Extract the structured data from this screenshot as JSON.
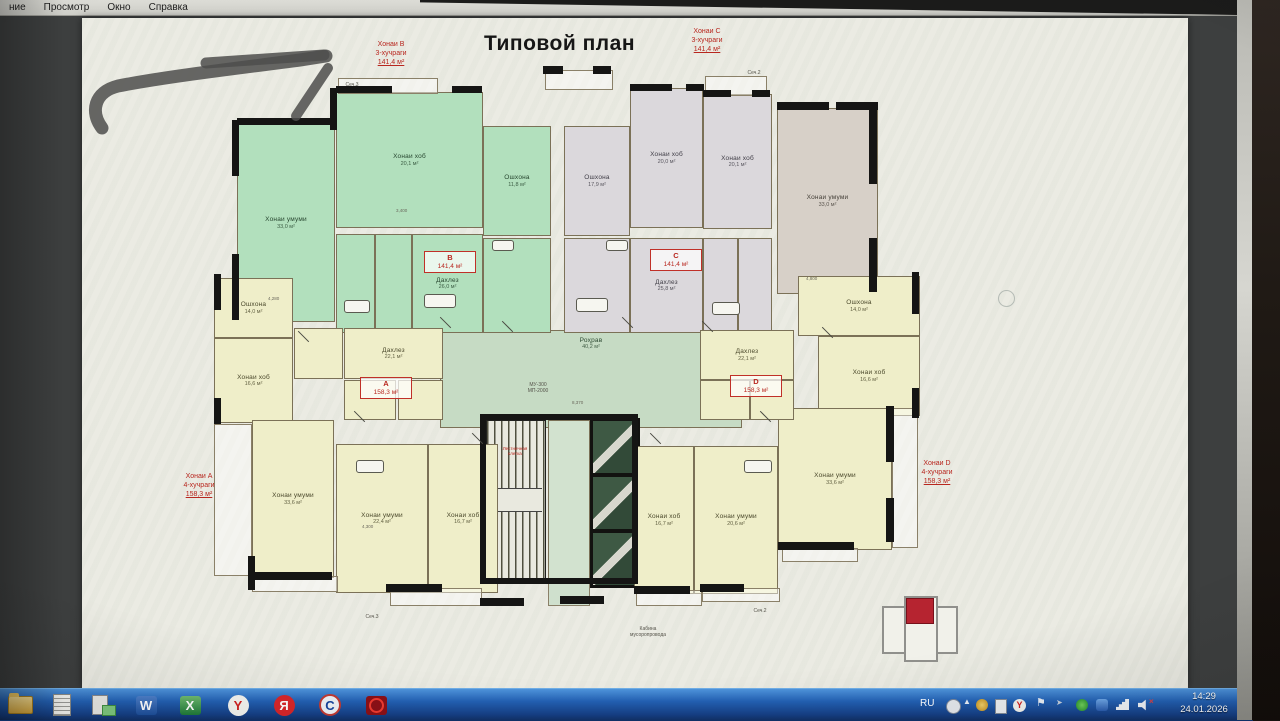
{
  "window": {
    "menu_items": [
      "ние",
      "Просмотр",
      "Окно",
      "Справка"
    ]
  },
  "plan": {
    "title": "Типовой план",
    "corner_labels": {
      "B": {
        "name": "Хонаи B",
        "type": "3-хучраги",
        "area": "141,4 м²"
      },
      "C": {
        "name": "Хонаи C",
        "type": "3-хучраги",
        "area": "141,4 м²"
      },
      "A": {
        "name": "Хонаи A",
        "type": "4-хучраги",
        "area": "158,3 м²"
      },
      "D": {
        "name": "Хонаи D",
        "type": "4-хучраги",
        "area": "158,3 м²"
      }
    },
    "unit_tags": {
      "B": {
        "letter": "B",
        "area": "141,4 м²"
      },
      "C": {
        "letter": "C",
        "area": "141,4 м²"
      },
      "A": {
        "letter": "A",
        "area": "158,3 м²"
      },
      "D": {
        "letter": "D",
        "area": "158,3 м²"
      }
    },
    "rooms": [
      {
        "apt": "B",
        "name": "Хонаи умуми",
        "area": "33,0 м²"
      },
      {
        "apt": "B",
        "name": "Хонаи хоб",
        "area": "20,1 м²"
      },
      {
        "apt": "B",
        "name": "Ошхона",
        "area": "11,8 м²"
      },
      {
        "apt": "B",
        "name": "Дахлез",
        "area": "26,0 м²"
      },
      {
        "apt": "C",
        "name": "Ошхона",
        "area": "17,9 м²"
      },
      {
        "apt": "C",
        "name": "Хонаи хоб",
        "area": "20,0 м²"
      },
      {
        "apt": "C",
        "name": "Хонаи хоб",
        "area": "20,1 м²"
      },
      {
        "apt": "C",
        "name": "Хонаи умуми",
        "area": "33,0 м²"
      },
      {
        "apt": "C",
        "name": "Дахлез",
        "area": "25,8 м²"
      },
      {
        "apt": "A",
        "name": "Ошхона",
        "area": "14,0 м²"
      },
      {
        "apt": "A",
        "name": "Хонаи хоб",
        "area": "16,6 м²"
      },
      {
        "apt": "A",
        "name": "Дахлез",
        "area": "22,1 м²"
      },
      {
        "apt": "A",
        "name": "Хонаи умуми",
        "area": "33,6 м²"
      },
      {
        "apt": "A",
        "name": "Хонаи умуми",
        "area": "22,4 м²"
      },
      {
        "apt": "A",
        "name": "Хонаи хоб",
        "area": "16,7 м²"
      },
      {
        "apt": "D",
        "name": "Ошхона",
        "area": "14,0 м²"
      },
      {
        "apt": "D",
        "name": "Хонаи хоб",
        "area": "16,6 м²"
      },
      {
        "apt": "D",
        "name": "Дахлез",
        "area": "22,1 м²"
      },
      {
        "apt": "D",
        "name": "Хонаи умуми",
        "area": "33,6 м²"
      },
      {
        "apt": "D",
        "name": "Хонаи умуми",
        "area": "20,6 м²"
      },
      {
        "apt": "D",
        "name": "Хонаи хоб",
        "area": "16,7 м²"
      }
    ],
    "corridor": {
      "name": "Роҳрав",
      "area": "40,2 м²"
    },
    "stair_label": {
      "l1": "Лестничная",
      "l2": "клетка"
    },
    "core_tag": {
      "l1": "МУ-300",
      "l2": "МП-2000"
    },
    "chute_note": {
      "l1": "Кабина",
      "l2": "мусоропровода"
    },
    "section_marks": [
      "Сеч.3",
      "Сеч.2",
      "Сеч.3",
      "Сеч.2"
    ],
    "dims": [
      "4,280",
      "3,400",
      "8,370",
      "4,800",
      "4,300"
    ]
  },
  "taskbar": {
    "icons": {
      "word": "W",
      "excel": "X",
      "yandex_browser": "Y",
      "yandex": "Я",
      "c_app": "C"
    },
    "tray": {
      "lang": "RU",
      "time": "14:29",
      "date": "24.01.2026"
    }
  },
  "colors": {
    "accent_red": "#b8271f",
    "apartment_green": "#b2e0bd",
    "apartment_gray": "#dbd8dc",
    "apartment_yellow": "#efeec9",
    "taskbar_blue": "#2361b4"
  }
}
